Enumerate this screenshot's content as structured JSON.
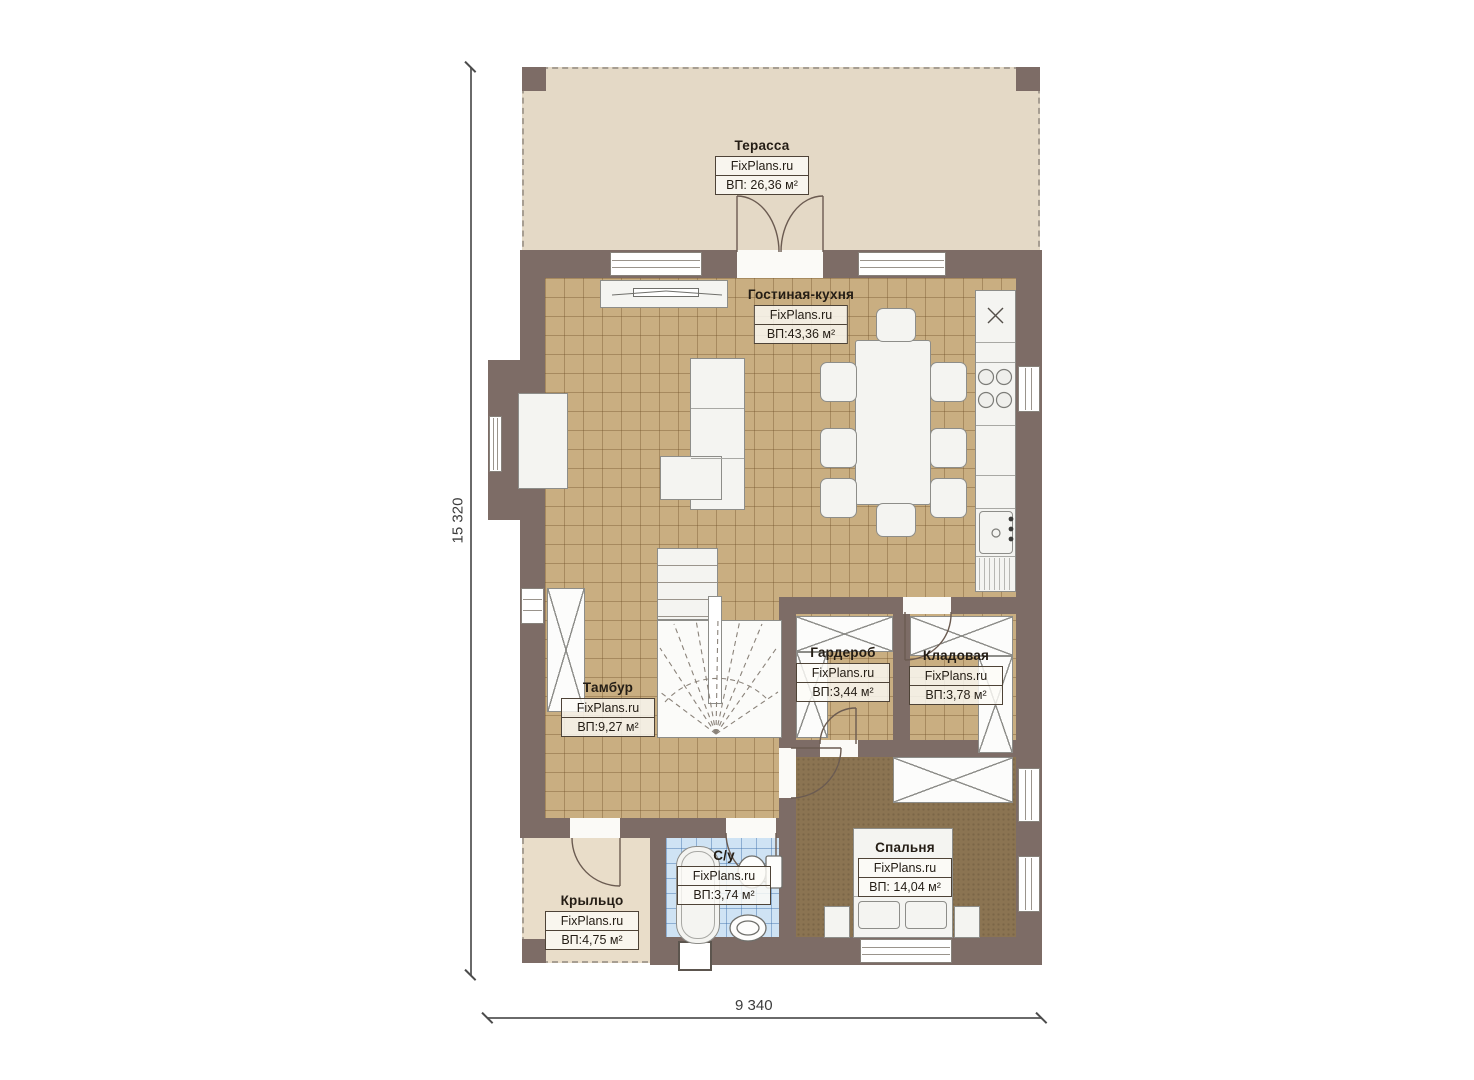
{
  "dimensions": {
    "height": "15 320",
    "width": "9 340"
  },
  "rooms": [
    {
      "key": "terrace",
      "name": "Терасса",
      "source": "FixPlans.ru",
      "area": "ВП: 26,36 м²"
    },
    {
      "key": "living-kitchen",
      "name": "Гостиная-кухня",
      "source": "FixPlans.ru",
      "area": "ВП:43,36 м²"
    },
    {
      "key": "vestibule",
      "name": "Тамбур",
      "source": "FixPlans.ru",
      "area": "ВП:9,27 м²"
    },
    {
      "key": "wardrobe",
      "name": "Гардероб",
      "source": "FixPlans.ru",
      "area": "ВП:3,44 м²"
    },
    {
      "key": "pantry",
      "name": "Кладовая",
      "source": "FixPlans.ru",
      "area": "ВП:3,78 м²"
    },
    {
      "key": "bathroom",
      "name": "С/у",
      "source": "FixPlans.ru",
      "area": "ВП:3,74 м²"
    },
    {
      "key": "bedroom",
      "name": "Спальня",
      "source": "FixPlans.ru",
      "area": "ВП: 14,04 м²"
    },
    {
      "key": "porch",
      "name": "Крыльцо",
      "source": "FixPlans.ru",
      "area": "ВП:4,75 м²"
    }
  ],
  "colors": {
    "wall": "#7d6c66",
    "tile_floor": "#c9ae81",
    "terrace_floor": "#e4d9c6",
    "porch_floor": "#e9ddc9",
    "bedroom_floor": "#8b7452",
    "bathroom_floor": "#cfe3f4",
    "furniture": "#f4f4f1"
  }
}
